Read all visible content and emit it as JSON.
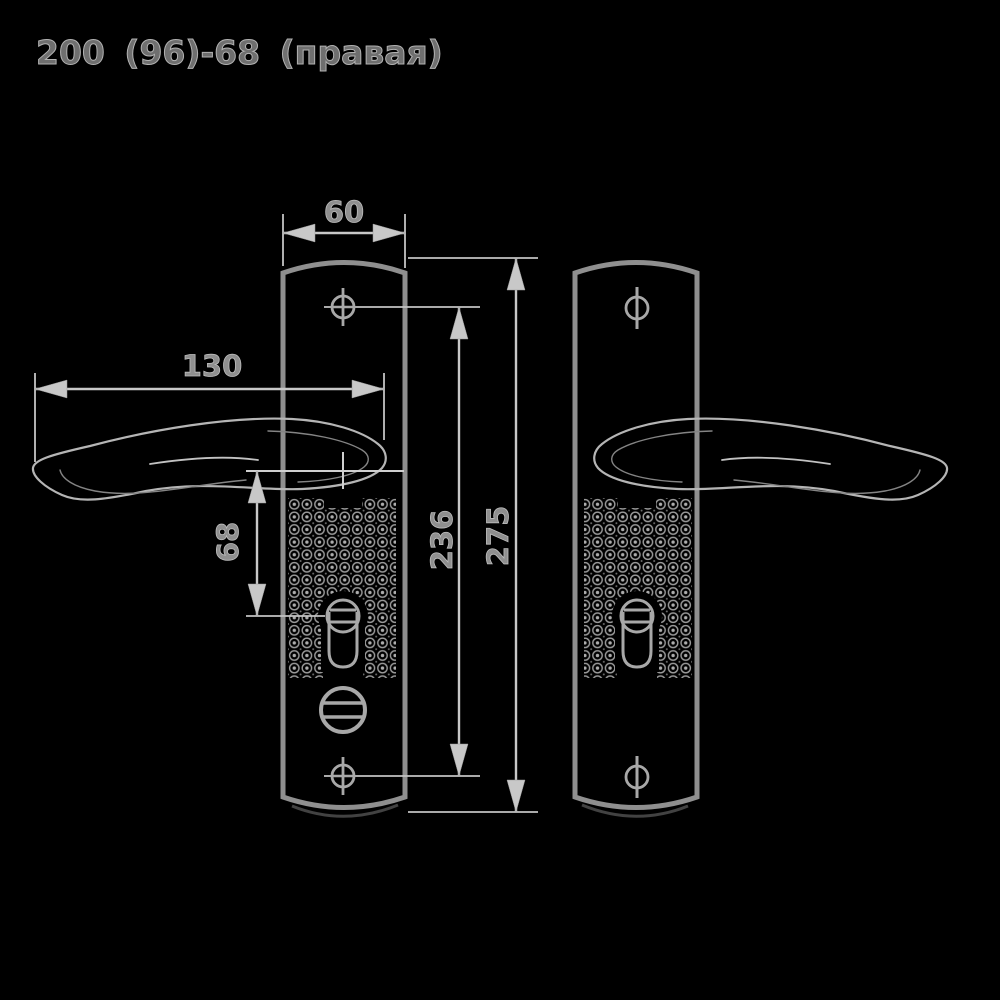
{
  "title": "200 (96)-68 (правая)",
  "dimensions": {
    "plate_width": "60",
    "handle_length": "130",
    "handle_to_keyhole": "68",
    "screw_spacing": "236",
    "plate_height": "275"
  },
  "colors": {
    "background": "#000000",
    "plate_outline": "#8f8f8f",
    "handle_outline": "#b5b5b5",
    "dimension_lines": "#c8c8c8",
    "label_text": "#8f8f8f"
  }
}
